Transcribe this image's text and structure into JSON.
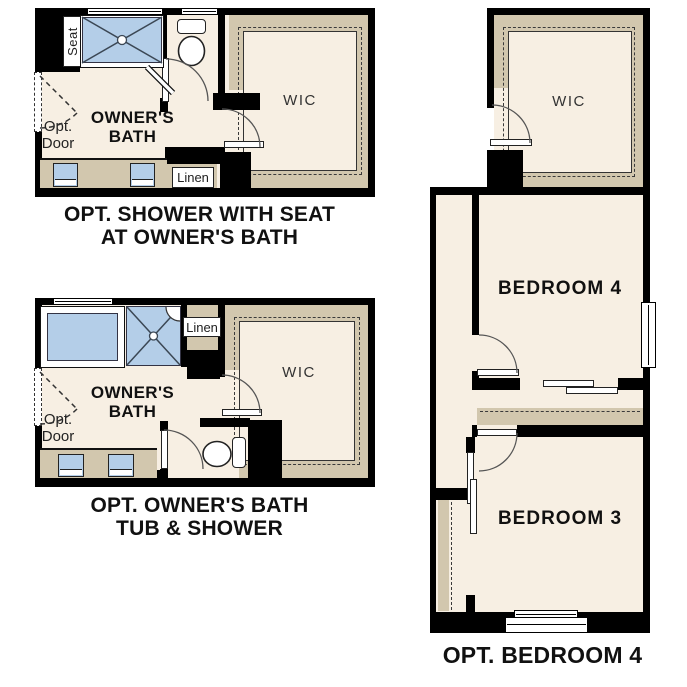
{
  "colors": {
    "floor": "#f7efe3",
    "shelf": "#d2c7ae",
    "fixture": "#b4cee8",
    "wall": "#000000",
    "text": "#111111"
  },
  "plan_shower_seat": {
    "caption_line1": "OPT. SHOWER WITH SEAT",
    "caption_line2": "AT OWNER'S BATH",
    "room_label_line1": "OWNER'S",
    "room_label_line2": "BATH",
    "seat_label": "Seat",
    "opt_door_line1": "Opt.",
    "opt_door_line2": "Door",
    "linen_label": "Linen",
    "wic_label": "WIC"
  },
  "plan_tub_shower": {
    "caption_line1": "OPT. OWNER'S BATH",
    "caption_line2": "TUB & SHOWER",
    "room_label_line1": "OWNER'S",
    "room_label_line2": "BATH",
    "opt_door_line1": "Opt.",
    "opt_door_line2": "Door",
    "linen_label": "Linen",
    "wic_label": "WIC"
  },
  "plan_bedroom4": {
    "caption": "OPT. BEDROOM 4",
    "wic_label": "WIC",
    "bedroom4_label": "BEDROOM 4",
    "bedroom3_label": "BEDROOM 3"
  }
}
